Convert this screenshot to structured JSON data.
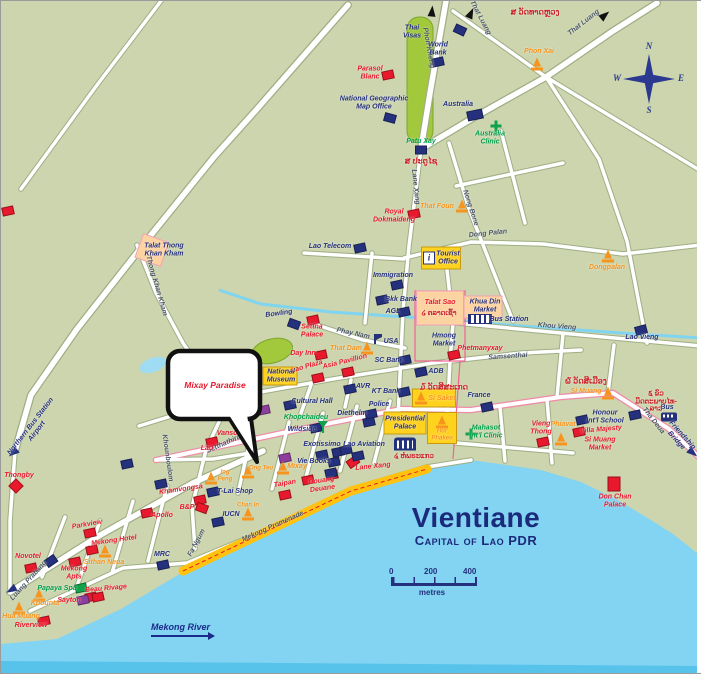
{
  "map": {
    "title": "Vientiane",
    "subtitle": "Capital of Lao PDR",
    "scale": {
      "t0": "0",
      "t1": "200",
      "t2": "400",
      "unit": "metres"
    },
    "river_label": "Mekong River",
    "callout_text": "Mixay Paradise",
    "compass": {
      "n": "N",
      "e": "E",
      "s": "S",
      "w": "W"
    }
  },
  "colors": {
    "land": "#ccd5ad",
    "water": "#82d4f2",
    "water_deep": "#58c3ea",
    "road": "#ffffff",
    "park": "#a2c83c",
    "promenade": "#ffc20e",
    "hotel_red": "#e8192c",
    "office_blue": "#26317e",
    "temple_orange": "#f7941d",
    "clinic_green": "#12a24b",
    "lao_red": "#cc2027",
    "title_navy": "#1b2a7b"
  },
  "labels": [
    {
      "t": "That Luang",
      "x": 479,
      "y": 17,
      "c": "road",
      "r": 62
    },
    {
      "t": "That Luang",
      "x": 583,
      "y": 22,
      "c": "road",
      "r": -38
    },
    {
      "t": "Phon Kheng",
      "x": 427,
      "y": 47,
      "c": "road",
      "r": 80
    },
    {
      "t": "Lane Xang",
      "x": 414,
      "y": 186,
      "c": "road",
      "r": 84
    },
    {
      "t": "Nong Bone",
      "x": 469,
      "y": 207,
      "c": "road",
      "r": 72
    },
    {
      "t": "Dong Palan",
      "x": 487,
      "y": 233,
      "c": "road",
      "r": -6
    },
    {
      "t": "Khou Vieng",
      "x": 556,
      "y": 326,
      "c": "road",
      "r": 4
    },
    {
      "t": "Samsenthai",
      "x": 507,
      "y": 356,
      "c": "road",
      "r": -4
    },
    {
      "t": "Samsenthai",
      "x": 241,
      "y": 387,
      "c": "road",
      "r": -22
    },
    {
      "t": "Phay Nam",
      "x": 352,
      "y": 333,
      "c": "road",
      "r": 12
    },
    {
      "t": "Setthathirat",
      "x": 224,
      "y": 443,
      "c": "road",
      "r": -24
    },
    {
      "t": "Khounboulom",
      "x": 166,
      "y": 457,
      "c": "road",
      "r": 82
    },
    {
      "t": "Fa Ngum",
      "x": 196,
      "y": 542,
      "c": "road",
      "r": -62
    },
    {
      "t": "Luang Prabang",
      "x": 28,
      "y": 580,
      "c": "road",
      "r": -48
    },
    {
      "t": "Thong Khan Kham",
      "x": 155,
      "y": 285,
      "c": "road",
      "r": 74
    },
    {
      "t": "Mekong Promenade",
      "x": 272,
      "y": 526,
      "c": "road",
      "r": -24
    },
    {
      "t": "Tha Deua",
      "x": 652,
      "y": 420,
      "c": "road",
      "r": 52
    },
    {
      "t": "Friendship\nBridge",
      "x": 678,
      "y": 437,
      "c": "roadblue",
      "r": 48
    },
    {
      "t": "Northern Bus Station\nAirport",
      "x": 33,
      "y": 428,
      "c": "roadblue",
      "r": -52
    },
    {
      "t": "Parasol\nBlanc",
      "x": 369,
      "y": 72,
      "c": "red"
    },
    {
      "t": "Royal\nDokmaideng",
      "x": 393,
      "y": 215,
      "c": "red"
    },
    {
      "t": "Settha\nPalace",
      "x": 311,
      "y": 330,
      "c": "red"
    },
    {
      "t": "Day Inn",
      "x": 302,
      "y": 353,
      "c": "red"
    },
    {
      "t": "Lao Plaza",
      "x": 306,
      "y": 366,
      "c": "red",
      "r": -16
    },
    {
      "t": "Asia Pavillion",
      "x": 344,
      "y": 361,
      "c": "red",
      "r": -14
    },
    {
      "t": "Taipan",
      "x": 284,
      "y": 483,
      "c": "red",
      "r": -10
    },
    {
      "t": "Douang\nDeuane",
      "x": 321,
      "y": 484,
      "c": "red",
      "r": -8
    },
    {
      "t": "Lane Xang",
      "x": 372,
      "y": 466,
      "c": "red",
      "r": -6
    },
    {
      "t": "Vansoke",
      "x": 230,
      "y": 433,
      "c": "red"
    },
    {
      "t": "Vayakorn",
      "x": 243,
      "y": 412,
      "c": "red",
      "r": -16
    },
    {
      "t": "Lao",
      "x": 206,
      "y": 448,
      "c": "red"
    },
    {
      "t": "Khamvongsa",
      "x": 180,
      "y": 489,
      "c": "red",
      "r": -8
    },
    {
      "t": "B&P",
      "x": 186,
      "y": 507,
      "c": "red"
    },
    {
      "t": "Apollo",
      "x": 161,
      "y": 515,
      "c": "red"
    },
    {
      "t": "Parkview",
      "x": 86,
      "y": 524,
      "c": "red",
      "r": -10
    },
    {
      "t": "Mekong Hotel",
      "x": 113,
      "y": 540,
      "c": "red",
      "r": -8
    },
    {
      "t": "Novotel",
      "x": 27,
      "y": 556,
      "c": "red"
    },
    {
      "t": "Mekong\nApts",
      "x": 73,
      "y": 572,
      "c": "red"
    },
    {
      "t": "Beau Rivage",
      "x": 105,
      "y": 588,
      "c": "red",
      "r": -5
    },
    {
      "t": "Riverview",
      "x": 30,
      "y": 625,
      "c": "red"
    },
    {
      "t": "Thongby",
      "x": 18,
      "y": 475,
      "c": "red"
    },
    {
      "t": "Phetmanyxay",
      "x": 479,
      "y": 348,
      "c": "red"
    },
    {
      "t": "Vieng\nThong",
      "x": 540,
      "y": 427,
      "c": "red"
    },
    {
      "t": "Villa Majesty",
      "x": 600,
      "y": 429,
      "c": "red",
      "r": -5
    },
    {
      "t": "Si Muang\nMarket",
      "x": 599,
      "y": 443,
      "c": "red"
    },
    {
      "t": "Don Chan\nPalace",
      "x": 614,
      "y": 500,
      "c": "red"
    },
    {
      "t": "Sayton",
      "x": 68,
      "y": 600,
      "c": "red"
    },
    {
      "t": "Talat Sao",
      "x": 439,
      "y": 302,
      "c": "red"
    },
    {
      "t": "Thai\nVisas",
      "x": 411,
      "y": 31,
      "c": "blue"
    },
    {
      "t": "World\nBank",
      "x": 437,
      "y": 48,
      "c": "blue"
    },
    {
      "t": "National Geographic\nMap Office",
      "x": 373,
      "y": 102,
      "c": "blue"
    },
    {
      "t": "Australia",
      "x": 457,
      "y": 104,
      "c": "blue"
    },
    {
      "t": "Lao Telecom",
      "x": 329,
      "y": 246,
      "c": "blue"
    },
    {
      "t": "Immigration",
      "x": 392,
      "y": 275,
      "c": "blue"
    },
    {
      "t": "Bkk Bank",
      "x": 400,
      "y": 299,
      "c": "blue"
    },
    {
      "t": "AGL",
      "x": 392,
      "y": 311,
      "c": "blue"
    },
    {
      "t": "USA",
      "x": 390,
      "y": 341,
      "c": "blue"
    },
    {
      "t": "SC Bank",
      "x": 388,
      "y": 360,
      "c": "blue"
    },
    {
      "t": "ADB",
      "x": 435,
      "y": 371,
      "c": "blue"
    },
    {
      "t": "KT Bank",
      "x": 385,
      "y": 391,
      "c": "blue"
    },
    {
      "t": "AVR",
      "x": 362,
      "y": 386,
      "c": "blue"
    },
    {
      "t": "France",
      "x": 478,
      "y": 395,
      "c": "blue"
    },
    {
      "t": "Honour\nInt'l School",
      "x": 604,
      "y": 416,
      "c": "blue"
    },
    {
      "t": "Lao Vieng",
      "x": 641,
      "y": 337,
      "c": "blue"
    },
    {
      "t": "MRC",
      "x": 161,
      "y": 554,
      "c": "blue"
    },
    {
      "t": "Bowling",
      "x": 278,
      "y": 313,
      "c": "blue",
      "r": -8
    },
    {
      "t": "Diethelm",
      "x": 351,
      "y": 413,
      "c": "blue"
    },
    {
      "t": "Wildside",
      "x": 301,
      "y": 429,
      "c": "blue"
    },
    {
      "t": "Exotissimo",
      "x": 321,
      "y": 444,
      "c": "blue"
    },
    {
      "t": "Lao Aviation",
      "x": 363,
      "y": 444,
      "c": "blue"
    },
    {
      "t": "Vie Books",
      "x": 313,
      "y": 461,
      "c": "blue"
    },
    {
      "t": "IUCN",
      "x": 230,
      "y": 514,
      "c": "blue"
    },
    {
      "t": "T-Lai Shop",
      "x": 234,
      "y": 491,
      "c": "blue"
    },
    {
      "t": "Police",
      "x": 378,
      "y": 404,
      "c": "blue"
    },
    {
      "t": "Cultural Hall",
      "x": 311,
      "y": 401,
      "c": "blue"
    },
    {
      "t": "Bus",
      "x": 666,
      "y": 407,
      "c": "blue"
    },
    {
      "t": "Hmong\nMarket",
      "x": 443,
      "y": 339,
      "c": "blue"
    },
    {
      "t": "Khua Din\nMarket",
      "x": 484,
      "y": 305,
      "c": "blue"
    },
    {
      "t": "Bus Station",
      "x": 508,
      "y": 319,
      "c": "blue"
    },
    {
      "t": "Talat Thong\nKhan Kham",
      "x": 163,
      "y": 249,
      "c": "blue"
    },
    {
      "t": "Tourist\nOffice",
      "x": 447,
      "y": 257,
      "c": "blue"
    },
    {
      "t": "National\nMuseum",
      "x": 280,
      "y": 375,
      "c": "blue"
    },
    {
      "t": "Presidential\nPalace",
      "x": 404,
      "y": 422,
      "c": "blue"
    },
    {
      "t": "Patu Xay",
      "x": 420,
      "y": 141,
      "c": "green"
    },
    {
      "t": "Khopchaideu",
      "x": 305,
      "y": 417,
      "c": "green"
    },
    {
      "t": "Papaya Spa",
      "x": 56,
      "y": 588,
      "c": "green"
    },
    {
      "t": "Australia\nClinic",
      "x": 489,
      "y": 137,
      "c": "green"
    },
    {
      "t": "Mahasot\nInt'l Clinic",
      "x": 485,
      "y": 431,
      "c": "green"
    },
    {
      "t": "Phon Xai",
      "x": 538,
      "y": 51,
      "c": "orange"
    },
    {
      "t": "That Foun",
      "x": 436,
      "y": 206,
      "c": "orange"
    },
    {
      "t": "Dongpalan",
      "x": 606,
      "y": 267,
      "c": "orange"
    },
    {
      "t": "That Dam",
      "x": 345,
      "y": 348,
      "c": "orange"
    },
    {
      "t": "Si Saket",
      "x": 441,
      "y": 398,
      "c": "orange"
    },
    {
      "t": "Hor\nPhakeo",
      "x": 441,
      "y": 434,
      "c": "orange",
      "s": 6
    },
    {
      "t": "Mixay",
      "x": 296,
      "y": 466,
      "c": "orange"
    },
    {
      "t": "Ing\nPeng",
      "x": 224,
      "y": 475,
      "c": "orange",
      "s": 6
    },
    {
      "t": "Ong Teu",
      "x": 260,
      "y": 468,
      "c": "orange",
      "s": 6
    },
    {
      "t": "Chan In",
      "x": 247,
      "y": 505,
      "c": "orange",
      "s": 6
    },
    {
      "t": "Si Muang",
      "x": 585,
      "y": 391,
      "c": "orange"
    },
    {
      "t": "Phiavat",
      "x": 562,
      "y": 424,
      "c": "orange"
    },
    {
      "t": "Sithan Neua",
      "x": 103,
      "y": 562,
      "c": "orange"
    },
    {
      "t": "Khounta",
      "x": 44,
      "y": 603,
      "c": "orange"
    },
    {
      "t": "Hua Muang",
      "x": 20,
      "y": 616,
      "c": "orange"
    },
    {
      "t": "ສ ວັດທາດຫຼວງ",
      "x": 534,
      "y": 12,
      "c": "lao"
    },
    {
      "t": "ສ ປະຕູໄຊ",
      "x": 420,
      "y": 161,
      "c": "lao"
    },
    {
      "t": "໒ ຕລາດເຊົ້າ",
      "x": 438,
      "y": 313,
      "c": "lao",
      "s": 7
    },
    {
      "t": "໓ ວັດສີສະເກດ",
      "x": 443,
      "y": 387,
      "c": "lao"
    },
    {
      "t": "໔ ຫໍພຣະແກວ",
      "x": 413,
      "y": 456,
      "c": "lao",
      "s": 7
    },
    {
      "t": "໖ ວັດສີເມືອງ",
      "x": 585,
      "y": 381,
      "c": "lao"
    },
    {
      "t": "໕ ຂົວມິດຕະພາບໄທ-ລາວ",
      "x": 655,
      "y": 401,
      "c": "lao",
      "s": 7
    }
  ],
  "markers": [
    {
      "k": "area",
      "c": "orange",
      "x": 439,
      "y": 307,
      "w": 46,
      "h": 33
    },
    {
      "k": "area",
      "c": "orange",
      "x": 482,
      "y": 306,
      "w": 37,
      "h": 21
    },
    {
      "k": "area",
      "c": "orange",
      "x": 151,
      "y": 249,
      "w": 26,
      "h": 24,
      "r": 20
    },
    {
      "k": "area",
      "c": "yellow",
      "x": 440,
      "y": 257,
      "w": 38,
      "h": 21
    },
    {
      "k": "area",
      "c": "yellow",
      "x": 279,
      "y": 375,
      "w": 33,
      "h": 17
    },
    {
      "k": "area",
      "c": "yellow",
      "x": 404,
      "y": 422,
      "w": 41,
      "h": 21
    },
    {
      "k": "area",
      "c": "yellow",
      "x": 433,
      "y": 397,
      "w": 42,
      "h": 17
    },
    {
      "k": "area",
      "c": "yellow",
      "x": 441,
      "y": 427,
      "w": 28,
      "h": 30
    },
    {
      "k": "box",
      "c": "red",
      "x": 387,
      "y": 74
    },
    {
      "k": "box",
      "c": "red",
      "x": 413,
      "y": 213
    },
    {
      "k": "box",
      "c": "red",
      "x": 312,
      "y": 319
    },
    {
      "k": "box",
      "c": "red",
      "x": 320,
      "y": 354
    },
    {
      "k": "box",
      "c": "red",
      "x": 317,
      "y": 377
    },
    {
      "k": "box",
      "c": "red",
      "x": 347,
      "y": 371
    },
    {
      "k": "box",
      "c": "red",
      "x": 284,
      "y": 494
    },
    {
      "k": "box",
      "c": "red",
      "x": 331,
      "y": 474
    },
    {
      "k": "box",
      "c": "red",
      "x": 352,
      "y": 461,
      "r": -35
    },
    {
      "k": "box",
      "c": "red",
      "x": 244,
      "y": 424
    },
    {
      "k": "box",
      "c": "red",
      "x": 211,
      "y": 441
    },
    {
      "k": "box",
      "c": "red",
      "x": 199,
      "y": 499
    },
    {
      "k": "box",
      "c": "red",
      "x": 201,
      "y": 507,
      "r": 20
    },
    {
      "k": "box",
      "c": "red",
      "x": 146,
      "y": 512
    },
    {
      "k": "box",
      "c": "red",
      "x": 89,
      "y": 532
    },
    {
      "k": "box",
      "c": "red",
      "x": 91,
      "y": 549
    },
    {
      "k": "box",
      "c": "red",
      "x": 30,
      "y": 567
    },
    {
      "k": "box",
      "c": "red",
      "x": 74,
      "y": 561
    },
    {
      "k": "box",
      "c": "red",
      "x": 90,
      "y": 596
    },
    {
      "k": "box",
      "c": "red",
      "x": 43,
      "y": 620
    },
    {
      "k": "box",
      "c": "red",
      "x": 453,
      "y": 354
    },
    {
      "k": "box",
      "c": "red",
      "x": 542,
      "y": 441
    },
    {
      "k": "box",
      "c": "red",
      "x": 578,
      "y": 431
    },
    {
      "k": "box",
      "c": "red",
      "x": 613,
      "y": 483,
      "r": 0,
      "w": 11,
      "h": 13
    },
    {
      "k": "box",
      "c": "red",
      "x": 7,
      "y": 210
    },
    {
      "k": "box",
      "c": "red",
      "x": 97,
      "y": 596
    },
    {
      "k": "box",
      "c": "red",
      "x": 307,
      "y": 479
    },
    {
      "k": "box",
      "c": "blue",
      "x": 459,
      "y": 29,
      "r": 25
    },
    {
      "k": "box",
      "c": "blue",
      "x": 437,
      "y": 61
    },
    {
      "k": "box",
      "c": "blue",
      "x": 389,
      "y": 117,
      "r": 15
    },
    {
      "k": "box",
      "c": "blue",
      "x": 474,
      "y": 114,
      "w": 14,
      "h": 8
    },
    {
      "k": "box",
      "c": "blue",
      "x": 359,
      "y": 247
    },
    {
      "k": "box",
      "c": "blue",
      "x": 396,
      "y": 284
    },
    {
      "k": "box",
      "c": "blue",
      "x": 381,
      "y": 299
    },
    {
      "k": "box",
      "c": "blue",
      "x": 403,
      "y": 311
    },
    {
      "k": "box",
      "c": "blue",
      "x": 404,
      "y": 359
    },
    {
      "k": "box",
      "c": "blue",
      "x": 420,
      "y": 371
    },
    {
      "k": "box",
      "c": "blue",
      "x": 403,
      "y": 391
    },
    {
      "k": "box",
      "c": "blue",
      "x": 349,
      "y": 388
    },
    {
      "k": "box",
      "c": "blue",
      "x": 486,
      "y": 406
    },
    {
      "k": "box",
      "c": "blue",
      "x": 581,
      "y": 419
    },
    {
      "k": "box",
      "c": "blue",
      "x": 640,
      "y": 329,
      "r": -15
    },
    {
      "k": "box",
      "c": "blue",
      "x": 162,
      "y": 564
    },
    {
      "k": "box",
      "c": "blue",
      "x": 293,
      "y": 323,
      "r": 20
    },
    {
      "k": "box",
      "c": "blue",
      "x": 368,
      "y": 421
    },
    {
      "k": "box",
      "c": "blue",
      "x": 315,
      "y": 427
    },
    {
      "k": "box",
      "c": "blue",
      "x": 337,
      "y": 451
    },
    {
      "k": "box",
      "c": "blue",
      "x": 357,
      "y": 455
    },
    {
      "k": "box",
      "c": "blue",
      "x": 370,
      "y": 413
    },
    {
      "k": "box",
      "c": "blue",
      "x": 289,
      "y": 404
    },
    {
      "k": "box",
      "c": "blue",
      "x": 634,
      "y": 414
    },
    {
      "k": "box",
      "c": "blue",
      "x": 50,
      "y": 560,
      "r": -35
    },
    {
      "k": "box",
      "c": "blue",
      "x": 333,
      "y": 461
    },
    {
      "k": "box",
      "c": "blue",
      "x": 321,
      "y": 454
    },
    {
      "k": "box",
      "c": "blue",
      "x": 345,
      "y": 449
    },
    {
      "k": "box",
      "c": "blue",
      "x": 330,
      "y": 472
    },
    {
      "k": "box",
      "c": "blue",
      "x": 420,
      "y": 149,
      "r": 0
    },
    {
      "k": "box",
      "c": "blue",
      "x": 217,
      "y": 521
    },
    {
      "k": "box",
      "c": "blue",
      "x": 212,
      "y": 491
    },
    {
      "k": "box",
      "c": "blue",
      "x": 126,
      "y": 463
    },
    {
      "k": "box",
      "c": "blue",
      "x": 160,
      "y": 483
    },
    {
      "k": "box",
      "c": "purple",
      "x": 82,
      "y": 599
    },
    {
      "k": "box",
      "c": "purple",
      "x": 284,
      "y": 457
    },
    {
      "k": "box",
      "c": "purple",
      "x": 263,
      "y": 409
    },
    {
      "k": "box",
      "c": "green",
      "x": 80,
      "y": 587
    },
    {
      "k": "cross",
      "x": 495,
      "y": 125
    },
    {
      "k": "cross",
      "x": 470,
      "y": 433
    },
    {
      "k": "flag",
      "x": 377,
      "y": 338
    },
    {
      "k": "diamond",
      "x": 15,
      "y": 485,
      "r": 45
    },
    {
      "k": "bus",
      "x": 668,
      "y": 416
    },
    {
      "k": "hatch",
      "x": 479,
      "y": 318
    },
    {
      "k": "info",
      "x": 428,
      "y": 257
    },
    {
      "k": "building",
      "x": 404,
      "y": 443
    },
    {
      "k": "martini",
      "x": 322,
      "y": 426
    },
    {
      "k": "stupa",
      "x": 536,
      "y": 63
    },
    {
      "k": "stupa",
      "x": 461,
      "y": 205
    },
    {
      "k": "stupa",
      "x": 607,
      "y": 255
    },
    {
      "k": "stupa",
      "x": 366,
      "y": 347
    },
    {
      "k": "stupa",
      "x": 420,
      "y": 397
    },
    {
      "k": "stupa",
      "x": 441,
      "y": 421
    },
    {
      "k": "stupa",
      "x": 282,
      "y": 467
    },
    {
      "k": "stupa",
      "x": 210,
      "y": 477
    },
    {
      "k": "stupa",
      "x": 247,
      "y": 471
    },
    {
      "k": "stupa",
      "x": 247,
      "y": 513
    },
    {
      "k": "stupa",
      "x": 607,
      "y": 392
    },
    {
      "k": "stupa",
      "x": 560,
      "y": 438
    },
    {
      "k": "stupa",
      "x": 104,
      "y": 550
    },
    {
      "k": "stupa",
      "x": 38,
      "y": 594
    },
    {
      "k": "stupa",
      "x": 18,
      "y": 607
    },
    {
      "k": "arrow",
      "c": "black",
      "x": 431,
      "y": 10,
      "r": -85
    },
    {
      "k": "arrow",
      "c": "black",
      "x": 470,
      "y": 12,
      "r": -65
    },
    {
      "k": "arrow",
      "c": "black",
      "x": 604,
      "y": 14,
      "r": -40
    },
    {
      "k": "arrow",
      "c": "blue",
      "x": 12,
      "y": 452,
      "r": 140
    },
    {
      "k": "arrow",
      "c": "blue",
      "x": 10,
      "y": 589,
      "r": 150
    },
    {
      "k": "arrow",
      "c": "blue",
      "x": 692,
      "y": 452,
      "r": 40
    }
  ]
}
